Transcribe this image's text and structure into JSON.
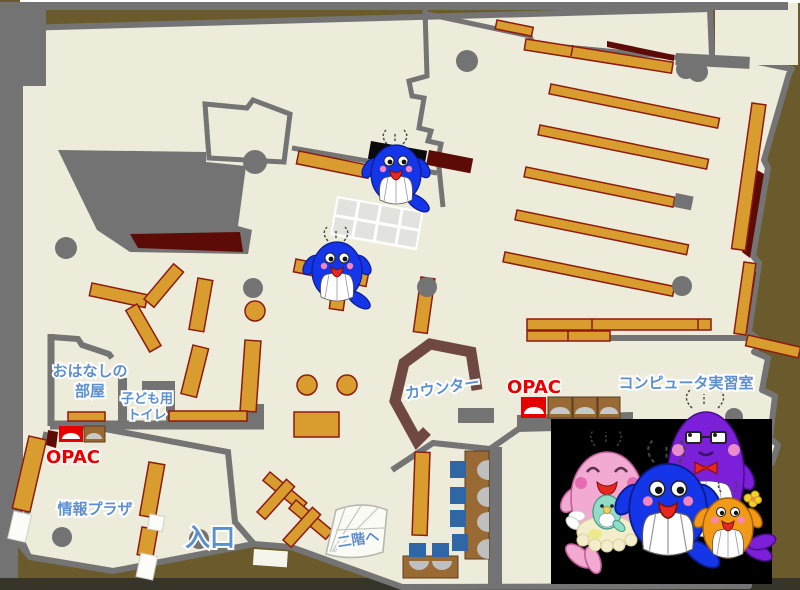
{
  "labels": {
    "storytelling_room_line1": "おはなしの",
    "storytelling_room_line2": "部屋",
    "kids_toilet_line1": "子ども用",
    "kids_toilet_line2": "トイレ",
    "opac": "OPAC",
    "info_plaza": "情報プラザ",
    "entrance": "入口",
    "to_second_floor": "二階へ",
    "counter": "カウンター",
    "computer_room": "コンピュータ実習室"
  },
  "colors": {
    "outer_background": "#6A5A2C",
    "floor": "#EDEBDA",
    "wall_gray": "#747474",
    "shelf_orange": "#D89C2F",
    "shelf_border": "#8C1B10",
    "accent_maroon": "#5C0B06",
    "opac_red": "#E60000",
    "label_blue": "#5C8FD0",
    "counter_brown": "#6F4843",
    "table_brown": "#9A6A35",
    "chair_blue": "#2E66A6",
    "mascot_blue": "#1536E8",
    "mascot_pink": "#F2A9D2",
    "mascot_purple": "#7B1FD9",
    "mascot_orange": "#F09A18",
    "photo_panel": "#000000"
  }
}
